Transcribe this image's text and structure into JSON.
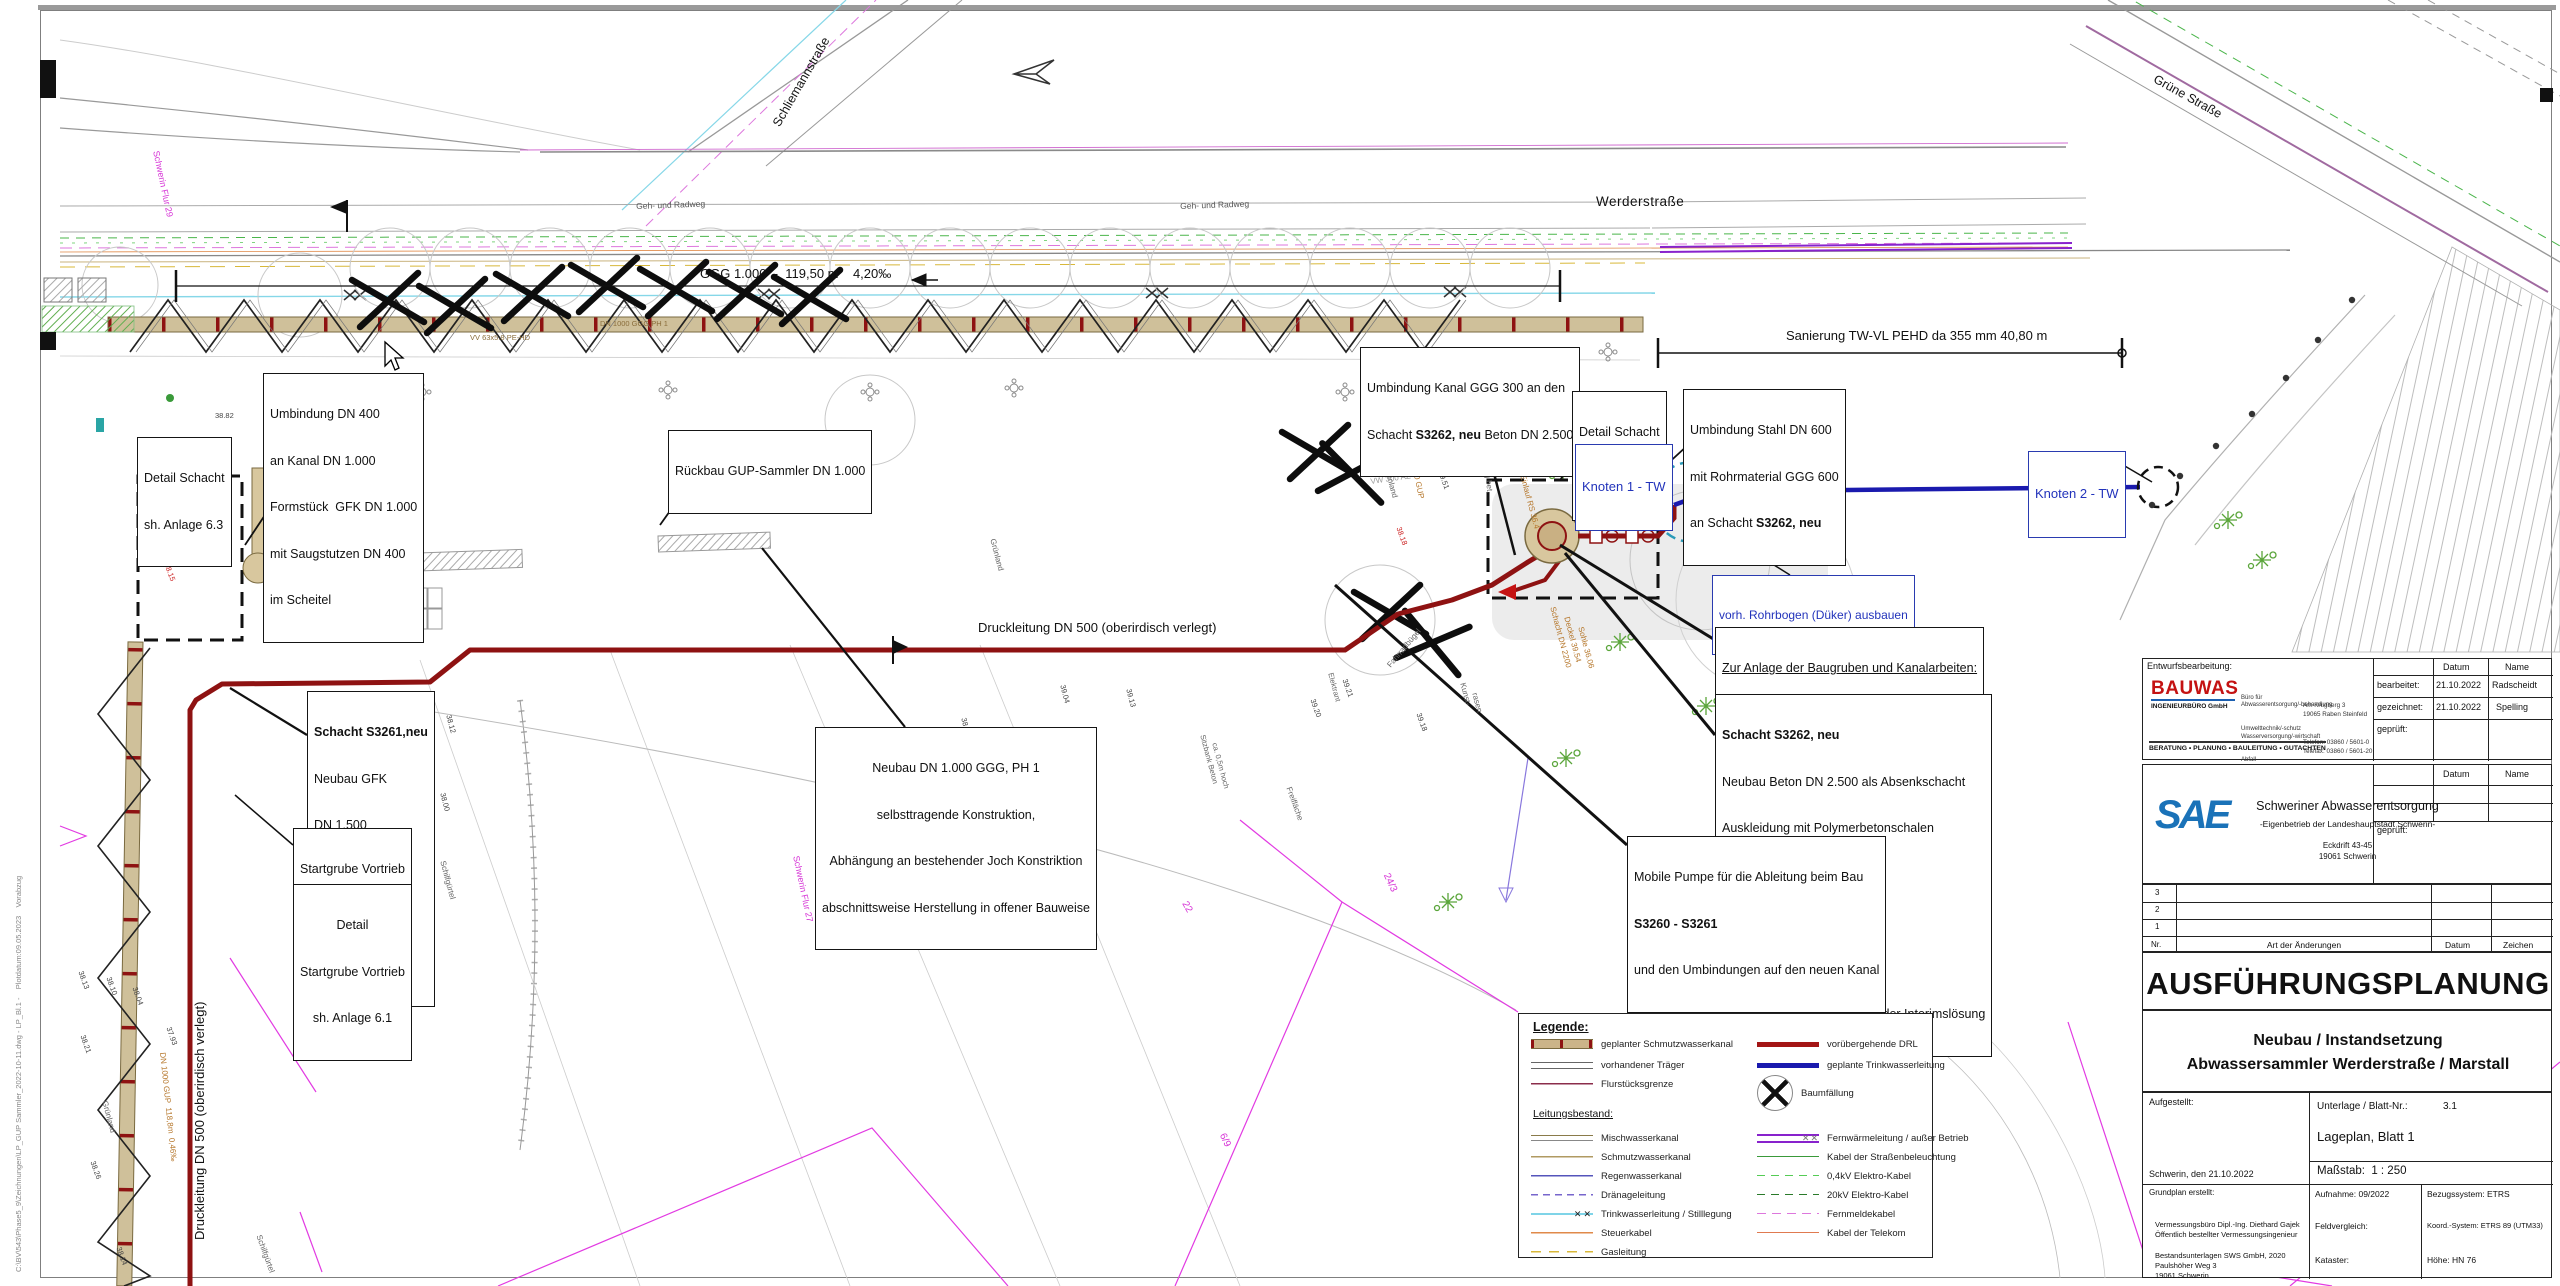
{
  "labels": {
    "werder": "Werderstraße",
    "schliemann": "Schliemannstraße",
    "gruene": "Grüne Straße",
    "druck": "Druckleitung DN 500 (oberirdisch verlegt)"
  },
  "dims": {
    "ggg": "GGG 1.000  -  119,50 m    4,20‰",
    "sanierung": "Sanierung TW-VL PEHD da 355 mm 40,80 m"
  },
  "notes": {
    "umb400": [
      "Umbindung DN 400",
      "an Kanal DN 1.000",
      "Formstück  GFK DN 1.000",
      "mit Saugstutzen DN 400",
      "im Scheitel"
    ],
    "d63": [
      "Detail Schacht",
      "sh. Anlage 6.3"
    ],
    "rueckbau": "Rückbau GUP-Sammler DN 1.000",
    "umb300": {
      "l1": "Umbindung Kanal GGG 300 an den",
      "l2a": "Schacht ",
      "l2b": "S3262, neu",
      "l2c": " Beton DN 2.500"
    },
    "d62": [
      "Detail Schacht",
      "sh. Anlage 6.2"
    ],
    "stahl": {
      "l1": "Umbindung Stahl DN 600",
      "l2": "mit Rohrmaterial GGG 600",
      "l3a": "an Schacht ",
      "l3b": "S3262, neu"
    },
    "k1": "Knoten 1 - TW",
    "k2": "Knoten 2 - TW",
    "rohr": "vorh. Rohrbogen (Düker) ausbauen",
    "zur": {
      "l1": "Zur Anlage der Baugruben und Kanalarbeiten:",
      "l2": "Abräumen der Fläche Spielplatz und",
      "l3": "Wiederherstellung nach Bauende"
    },
    "s3262": {
      "title": "Schacht S3262, neu",
      "lines": [
        "Neubau Be­ton DN 2.500 als Absenkschacht",
        "Auskleidung mit Polymerbetonschalen",
        "D:      39,54",
        "RSE:  36,17",
        "RSA:  35,77",
        "Nutzung als Pumpenvorlage der Interimslösung"
      ]
    },
    "mobile": {
      "l1": "Mobile Pumpe für die Ableitung beim Bau",
      "l2": "S3260 - S3261",
      "l3": "und den Umbindungen auf den neuen Kanal"
    },
    "s3261": {
      "title": "Schacht S3261,neu",
      "lines": [
        "Neubau GFK",
        "DN 1.500",
        "D:      38,75",
        "RSE:  35,27",
        "RSA:  35,26"
      ]
    },
    "start": [
      "Startgrube Vortrieb",
      "(Trägerbohlwand)",
      "6,84 x 3,80m"
    ],
    "dstart": [
      "Detail",
      "Startgrube Vortrieb",
      "sh. Anlage 6.1"
    ],
    "neubau": [
      "Neubau DN 1.000 GGG, PH 1",
      "selbsttragende Konstruktion,",
      "Abhängung an bestehender Joch Konstriktion",
      "abschnittsweise Herstellung in offener Bauweise"
    ]
  },
  "legend": {
    "title": "Legende:",
    "subtitle": "Leitungsbestand:",
    "left": [
      {
        "y": 24,
        "sw": "sw-geplant",
        "label": "geplanter Schmutzwasserkanal"
      },
      {
        "y": 45,
        "sw": "sw-traeger",
        "label": "vorhandener Träger"
      },
      {
        "y": 64,
        "sw": "sw-flur",
        "label": "Flurstücksgrenze"
      },
      {
        "y": 118,
        "sw": "sw-misch",
        "label": "Mischwasserkanal"
      },
      {
        "y": 137,
        "sw": "sw-schmutz",
        "label": "Schmutzwasserkanal"
      },
      {
        "y": 156,
        "sw": "sw-regen",
        "label": "Regenwasserkanal"
      },
      {
        "y": 175,
        "sw": "sw-draen",
        "label": "Dränageleitung"
      },
      {
        "y": 194,
        "sw": "sw-twstill",
        "g": "✕✕",
        "label": "Trinkwasserleitung / Stilllegung"
      },
      {
        "y": 213,
        "sw": "sw-steuer",
        "label": "Steuerkabel"
      },
      {
        "y": 232,
        "sw": "sw-gas",
        "label": "Gasleitung"
      }
    ],
    "right": [
      {
        "y": 24,
        "sw": "sw-drl",
        "label": "vorübergehende DRL"
      },
      {
        "y": 45,
        "sw": "sw-twneu",
        "label": "geplante Trinkwasserleitung"
      },
      {
        "y": 60,
        "sw": "sw-baum",
        "label": "Baumfällung",
        "cls": "tall"
      },
      {
        "y": 118,
        "sw": "sw-fernw",
        "g": "✕✕",
        "label": "Fernwärmeleitung / außer Betrieb"
      },
      {
        "y": 137,
        "sw": "sw-strbel",
        "label": "Kabel der Straßenbeleuchtung"
      },
      {
        "y": 156,
        "sw": "sw-04kv",
        "label": "0,4kV Elektro-Kabel"
      },
      {
        "y": 175,
        "sw": "sw-20kv",
        "label": "20kV Elektro-Kabel"
      },
      {
        "y": 194,
        "sw": "sw-fmk",
        "label": "Fernmeldekabel"
      },
      {
        "y": 213,
        "sw": "sw-telekom",
        "label": "Kabel der Telekom"
      }
    ]
  },
  "titleblock": {
    "entw": "Entwurfsbearbeitung:",
    "bauwas": {
      "name": "BAUWAS",
      "sub": "INGENIEURBÜRO GmbH",
      "services": [
        "Büro für",
        "Abwasserentsorgung/-behandlung",
        "Umwelttechnik/-schutz",
        "Wasserversorgung/-wirtschaft",
        "Abfall",
        "Straßenbau"
      ],
      "address": [
        "Am Krugberg 3",
        "19065 Raben Steinfeld",
        "Telefon: 03860 / 5601-0",
        "Telefax: 03860 / 5601-20",
        "e-mail:  info@ib-bauwas.de",
        "internet: www.ib-bauwas.de"
      ],
      "tagline": "BERATUNG • PLANUNG • BAULEITUNG • GUTACHTEN"
    },
    "t1": {
      "datum": "Datum",
      "name": "Name",
      "r1": "bearbeitet:",
      "r1d": "21.10.2022",
      "r1n": "Radscheidt",
      "r2": "gezeichnet:",
      "r2d": "21.10.2022",
      "r2n": "Spelling",
      "r3": "geprüft:"
    },
    "sae": {
      "logo": "SAE",
      "org": "Schweriner Abwasserentsorgung",
      "sub": "-Eigenbetrieb der Landeshauptstadt Schwerin-",
      "addr1": "Eckdrift 43-45",
      "addr2": "19061 Schwerin",
      "datum": "Datum",
      "name": "Name",
      "gepr": "geprüft:"
    },
    "rev": {
      "r3": "3",
      "r2": "2",
      "r1": "1",
      "nr": "Nr.",
      "art": "Art der Änderungen",
      "datum": "Datum",
      "zeichen": "Zeichen"
    },
    "main_title": "AUSFÜHRUNGSPLANUNG",
    "sub1": "Neubau / Instandsetzung",
    "sub2": "Abwassersammler Werderstraße / Marstall",
    "lower": {
      "aufgestellt": "Aufgestellt:",
      "ort": "Schwerin, den 21.10.2022",
      "unterlage": "Unterlage / Blatt-Nr.:",
      "unterlage_nr": "3.1",
      "lageplan": "Lageplan, Blatt 1",
      "massstab": "Maßstab:  1 : 250",
      "grundplan": "Grundplan erstellt:",
      "gp_lines": [
        "Vermessungsbüro Dipl.-Ing. Diethard Gajek",
        "Öffentlich bestellter Vermessungsingenieur",
        "Paulshöher Weg 3",
        "19061 Schwerin"
      ],
      "bestand": "Bestandsunterlagen SWS GmbH, 2020",
      "aufnahme": "Aufnahme: 09/2022",
      "bezug": "Bezugssystem: ETRS",
      "feld": "Feldvergleich:",
      "koord": "Koord.-System: ETRS 89 (UTM33)",
      "kataster": "Kataster:",
      "hoehe": "Höhe: HN 76"
    }
  },
  "stamp": "C:\\BV\\543\\Phase5_9\\Zeichnungen\\LP_GUP Sammler_2022-10-11.dwg - LP_Bl.1 -    Plotdatum:09.05.2023    Vorabzug",
  "deco": [
    {
      "t": "Schwerin Flur 29",
      "x": 160,
      "y": 150,
      "r": 78,
      "s": 9,
      "c": "#d633d6"
    },
    {
      "t": "Schwerin Flur 27",
      "x": 800,
      "y": 855,
      "r": 78,
      "s": 9,
      "c": "#d633d6"
    },
    {
      "t": "24/3",
      "x": 1390,
      "y": 872,
      "r": 65,
      "s": 10,
      "c": "#d633d6"
    },
    {
      "t": "22",
      "x": 1188,
      "y": 900,
      "r": 60,
      "s": 10,
      "c": "#d633d6"
    },
    {
      "t": "6/9",
      "x": 1226,
      "y": 1132,
      "r": 65,
      "s": 10,
      "c": "#d633d6"
    },
    {
      "t": "38.82",
      "x": 215,
      "y": 412,
      "r": 0,
      "s": 7.5
    },
    {
      "t": "38.62",
      "x": 352,
      "y": 462,
      "r": 0,
      "s": 7.5
    },
    {
      "t": "38.57",
      "x": 392,
      "y": 488,
      "r": 80,
      "s": 7.5
    },
    {
      "t": "38.79",
      "x": 270,
      "y": 474,
      "r": 75,
      "s": 7.5
    },
    {
      "t": "38.75",
      "x": 338,
      "y": 440,
      "r": 75,
      "s": 7.5
    },
    {
      "t": "38.22",
      "x": 342,
      "y": 460,
      "r": 70,
      "s": 7.5,
      "c": "#cc2222"
    },
    {
      "t": "38.15",
      "x": 170,
      "y": 562,
      "r": 70,
      "s": 7.5,
      "c": "#cc2222"
    },
    {
      "t": "38.18",
      "x": 1402,
      "y": 526,
      "r": 70,
      "s": 7.5,
      "c": "#cc2222"
    },
    {
      "t": "39.04",
      "x": 1066,
      "y": 684,
      "r": 75,
      "s": 7.5
    },
    {
      "t": "39.13",
      "x": 1132,
      "y": 688,
      "r": 75,
      "s": 7.5
    },
    {
      "t": "38.90",
      "x": 967,
      "y": 717,
      "r": 75,
      "s": 7.5
    },
    {
      "t": "39.51",
      "x": 1444,
      "y": 470,
      "r": 70,
      "s": 7.5
    },
    {
      "t": "39.21",
      "x": 1348,
      "y": 678,
      "r": 70,
      "s": 7.5
    },
    {
      "t": "39.20",
      "x": 1316,
      "y": 698,
      "r": 70,
      "s": 7.5
    },
    {
      "t": "39.18",
      "x": 1422,
      "y": 712,
      "r": 70,
      "s": 7.5
    },
    {
      "t": "38.13",
      "x": 84,
      "y": 970,
      "r": 70,
      "s": 7.5
    },
    {
      "t": "38.10",
      "x": 112,
      "y": 976,
      "r": 70,
      "s": 7.5
    },
    {
      "t": "38.04",
      "x": 138,
      "y": 986,
      "r": 70,
      "s": 7.5
    },
    {
      "t": "37.93",
      "x": 172,
      "y": 1026,
      "r": 70,
      "s": 7.5
    },
    {
      "t": "38.21",
      "x": 86,
      "y": 1034,
      "r": 70,
      "s": 7.5
    },
    {
      "t": "38.26",
      "x": 96,
      "y": 1160,
      "r": 70,
      "s": 7.5
    },
    {
      "t": "38.14",
      "x": 122,
      "y": 1246,
      "r": 70,
      "s": 7.5
    },
    {
      "t": "38.12",
      "x": 452,
      "y": 714,
      "r": 75,
      "s": 7.5
    },
    {
      "t": "38.00",
      "x": 446,
      "y": 792,
      "r": 75,
      "s": 7.5
    },
    {
      "t": "Grünland",
      "x": 1390,
      "y": 465,
      "r": 75,
      "s": 8,
      "c": "#666"
    },
    {
      "t": "Grünland",
      "x": 996,
      "y": 538,
      "r": 75,
      "s": 8,
      "c": "#666"
    },
    {
      "t": "Grünland",
      "x": 108,
      "y": 1100,
      "r": 75,
      "s": 8,
      "c": "#666"
    },
    {
      "t": "Schilfgürtel",
      "x": 446,
      "y": 860,
      "r": 75,
      "s": 8,
      "c": "#666"
    },
    {
      "t": "Schilfgürtel",
      "x": 262,
      "y": 1234,
      "r": 70,
      "s": 8,
      "c": "#666"
    },
    {
      "t": "Freifläche",
      "x": 1292,
      "y": 786,
      "r": 70,
      "s": 8,
      "c": "#666"
    },
    {
      "t": "Kunst-",
      "x": 1466,
      "y": 682,
      "r": 75,
      "s": 8,
      "c": "#666"
    },
    {
      "t": "rasen",
      "x": 1478,
      "y": 692,
      "r": 75,
      "s": 8,
      "c": "#666"
    },
    {
      "t": "Gehweg bet.",
      "x": 1488,
      "y": 448,
      "r": 83,
      "s": 8,
      "c": "#666"
    },
    {
      "t": "Geh- und Radweg",
      "x": 636,
      "y": 202,
      "r": -2,
      "s": 8.5,
      "c": "#555"
    },
    {
      "t": "Geh- und Radweg",
      "x": 1180,
      "y": 202,
      "r": -2,
      "s": 8.5,
      "c": "#555"
    },
    {
      "t": "Fahrradbügel",
      "x": 1386,
      "y": 664,
      "r": -50,
      "s": 8,
      "c": "#666"
    },
    {
      "t": "Elektrant",
      "x": 1334,
      "y": 672,
      "r": 75,
      "s": 7.5,
      "c": "#666"
    },
    {
      "t": "Sitzbank Beton",
      "x": 1206,
      "y": 734,
      "r": 75,
      "s": 7.5,
      "c": "#666"
    },
    {
      "t": "ca. 0,5m hoch",
      "x": 1218,
      "y": 742,
      "r": 75,
      "s": 7.5,
      "c": "#666"
    },
    {
      "t": "Auslauf RW 1000 GUP",
      "x": 1408,
      "y": 418,
      "r": 78,
      "s": 8,
      "c": "#b5762a"
    },
    {
      "t": "RS 35.86",
      "x": 1422,
      "y": 428,
      "r": 78,
      "s": 8,
      "c": "#b5762a"
    },
    {
      "t": "Einlauf RS 36.4",
      "x": 1526,
      "y": 474,
      "r": 75,
      "s": 8,
      "c": "#b5762a"
    },
    {
      "t": "Schacht DN 2200",
      "x": 1556,
      "y": 606,
      "r": 75,
      "s": 8,
      "c": "#b5762a"
    },
    {
      "t": "Deckel 39.54",
      "x": 1570,
      "y": 616,
      "r": 75,
      "s": 8,
      "c": "#b5762a"
    },
    {
      "t": "Sohle 36.06",
      "x": 1584,
      "y": 626,
      "r": 75,
      "s": 8,
      "c": "#b5762a"
    },
    {
      "t": "VV 63x5.8 PE-HD",
      "x": 470,
      "y": 334,
      "r": 0,
      "s": 7.5,
      "c": "#8a6d3b"
    },
    {
      "t": "DN 1000 GGG PH 1",
      "x": 600,
      "y": 320,
      "r": 0,
      "s": 7.5,
      "c": "#8a6d3b"
    },
    {
      "t": "DN 1000 GUP  118,8m  0,46‰",
      "x": 166,
      "y": 1052,
      "r": 84,
      "s": 8,
      "c": "#b5762a"
    },
    {
      "t": "VW 300 AZ",
      "x": 1370,
      "y": 478,
      "r": -8,
      "s": 8,
      "c": "#999"
    }
  ]
}
